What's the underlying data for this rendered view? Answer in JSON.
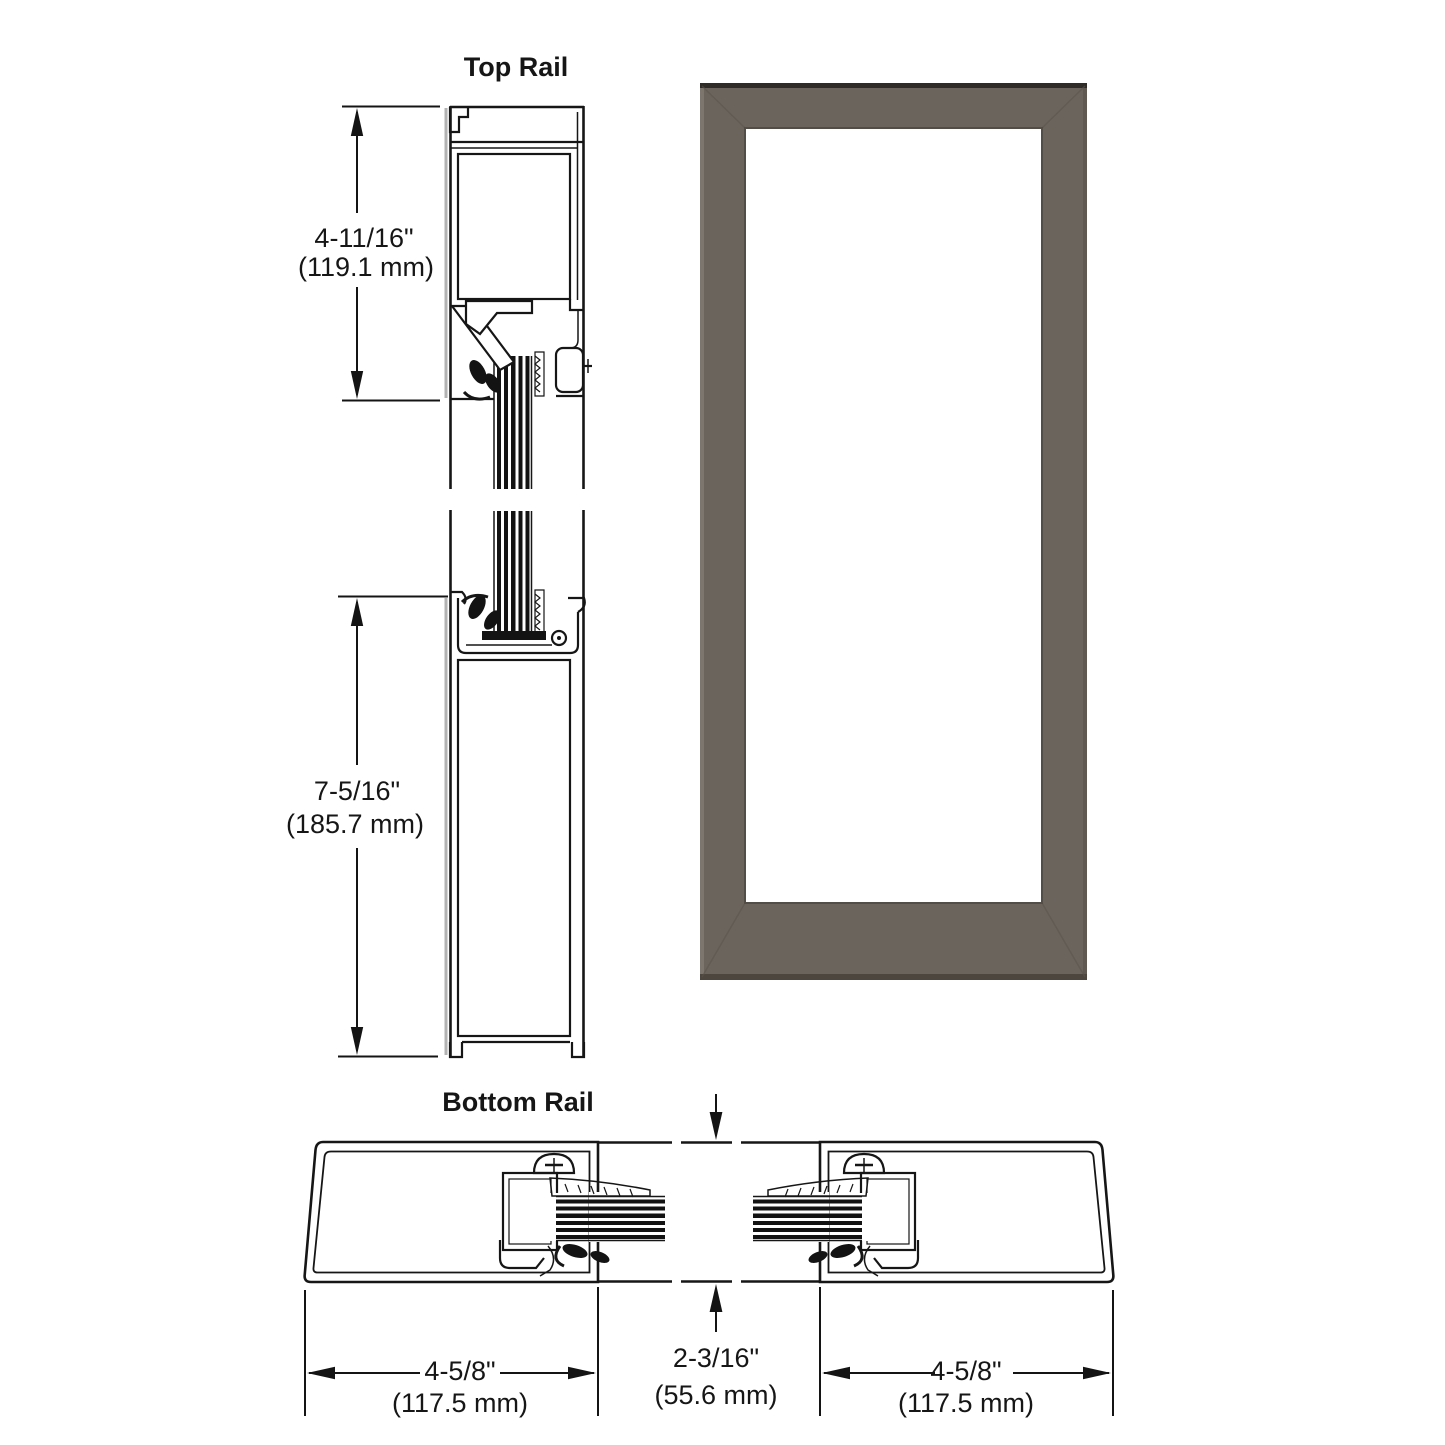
{
  "labels": {
    "top_rail": "Top Rail",
    "bottom_rail": "Bottom Rail"
  },
  "dimensions": {
    "top_rail": {
      "inches": "4-11/16\"",
      "mm": "(119.1 mm)"
    },
    "bottom_rail_height": {
      "inches": "7-5/16\"",
      "mm": "(185.7 mm)"
    },
    "left_stile": {
      "inches": "4-5/8\"",
      "mm": "(117.5 mm)"
    },
    "door_thickness": {
      "inches": "2-3/16\"",
      "mm": "(55.6 mm)"
    },
    "right_stile": {
      "inches": "4-5/8\"",
      "mm": "(117.5 mm)"
    }
  },
  "colors": {
    "line": "#161616",
    "frame": "#6b645d",
    "frame_top_edge": "#2f2b27",
    "frame_left_highlight": "#7d766e",
    "frame_right_shade": "#5f5952",
    "frame_bottom_edge": "#4c463f",
    "glass": "#ffffff",
    "glass_border": "#524d47",
    "background": "#ffffff"
  }
}
